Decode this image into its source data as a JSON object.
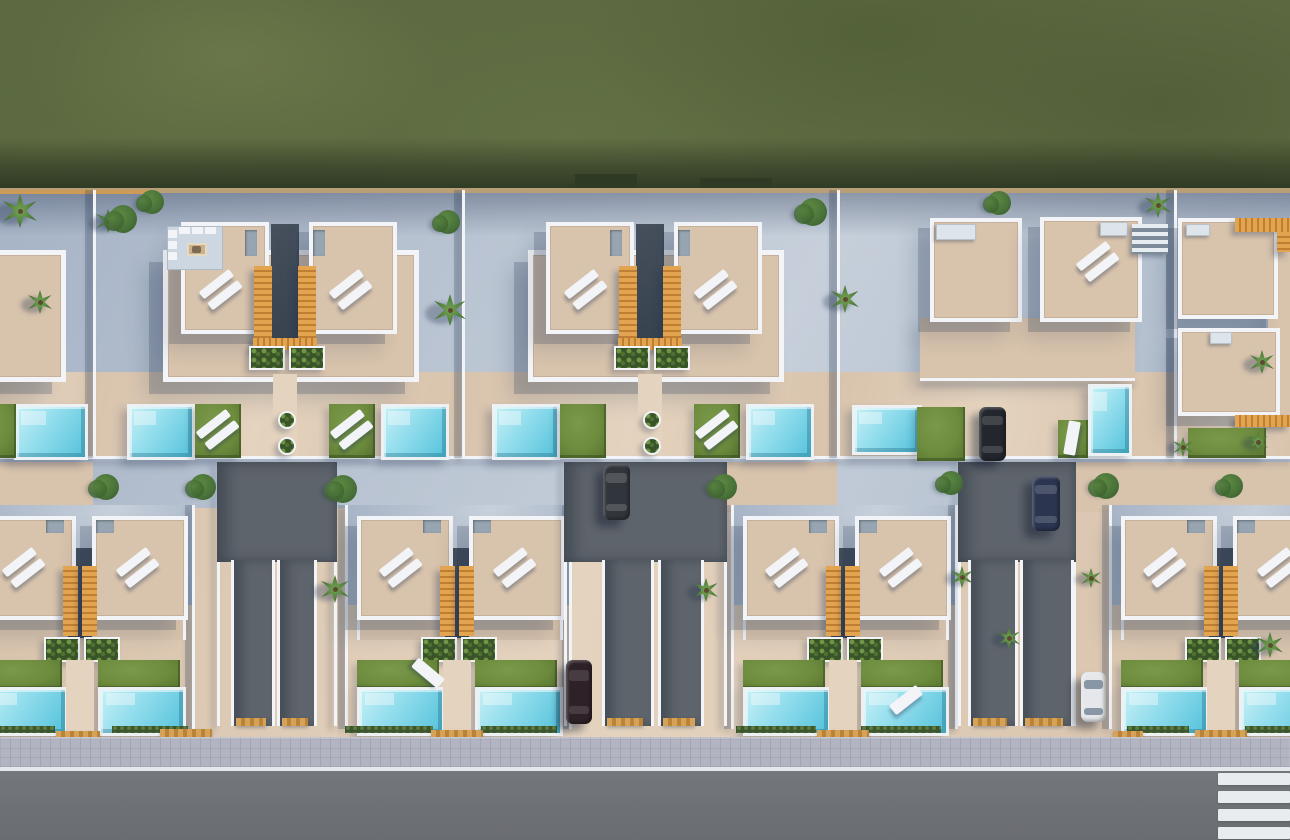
{
  "scene": {
    "width": 1290,
    "height": 840,
    "description": "aerial-3d-render-villa-development"
  },
  "colors": {
    "field": "#5c6941",
    "fieldDark": "#46522f",
    "paving": "#a7b4c6",
    "pavingLight": "#c6cfda",
    "beige": "#d8c3ac",
    "beigeLight": "#e4d3be",
    "beigeShade": "#c2ab92",
    "white": "#f2f4f7",
    "rim": "#eef1f4",
    "stairs": "#dd9b45",
    "lawn": "#6d8c3d",
    "lawnDark": "#57722f",
    "poolLight": "#c6f0f6",
    "pool": "#8fdcec",
    "poolDark": "#55c2da",
    "lane": "#5e646b",
    "road": "#6f7377",
    "sidewalk": "#b3b4c1",
    "stripe": "#e9ecee",
    "kerb": "#d09a4c",
    "treeGreen": "#497239",
    "treeDark": "#35592a",
    "backWall": "#b99f78",
    "backWallOrange": "#cd9a57",
    "kitchenFloor": "#ccd7e1",
    "equip": "#dde4ea",
    "shadowSoft": "rgba(38,54,84,0.22)"
  },
  "field": {
    "h": 190,
    "shadowY": 138,
    "shadowH": 52,
    "wallY": 188,
    "wallH": 5,
    "orangeSeg": [
      0,
      190,
      150,
      4
    ],
    "notches": [
      [
        575,
        174,
        62,
        16
      ],
      [
        700,
        178,
        72,
        12
      ]
    ]
  },
  "topRow": {
    "wallXs": [
      93,
      462,
      837,
      1174
    ],
    "frontRanges": [
      [
        0,
        93
      ],
      [
        93,
        462
      ],
      [
        462,
        837
      ],
      [
        837,
        1174
      ],
      [
        1174,
        1290
      ]
    ],
    "frontY": 372,
    "frontH": 86,
    "frontWallY": 456,
    "pairs": [
      {
        "cx": 285,
        "kitchen": true,
        "lawnLoungers": [
          "left",
          "right"
        ]
      },
      {
        "cx": 650,
        "kitchen": false,
        "lawnLoungers": [
          "right"
        ]
      }
    ],
    "partial": {
      "terrace": [
        -70,
        250,
        126,
        122
      ],
      "pool": [
        14,
        404,
        68,
        50
      ],
      "lawn": [
        -30,
        404,
        46,
        54
      ]
    }
  },
  "cornerTop": {
    "squares": [
      [
        930,
        218,
        84,
        96
      ],
      [
        1040,
        217,
        94,
        97
      ],
      [
        1178,
        218,
        92,
        93
      ],
      [
        1178,
        328,
        94,
        80
      ]
    ],
    "equip": [
      [
        936,
        224,
        40,
        16
      ],
      [
        1100,
        222,
        28,
        14
      ],
      [
        1186,
        224,
        24,
        12
      ],
      [
        1210,
        332,
        22,
        12
      ]
    ],
    "extStair": [
      1132,
      224,
      36,
      30
    ],
    "orangeH": [
      [
        1235,
        218,
        55,
        14
      ],
      [
        1235,
        415,
        55,
        12
      ]
    ],
    "orangeV": [
      [
        1277,
        232,
        13,
        20
      ]
    ],
    "terraces": [
      [
        920,
        318,
        215,
        62
      ],
      [
        1268,
        238,
        22,
        176
      ]
    ],
    "terraceWall": [
      920,
      378,
      215,
      3
    ],
    "hPool": [
      852,
      405,
      64,
      44
    ],
    "vPool": [
      1088,
      384,
      38,
      66
    ],
    "lawns": [
      [
        917,
        407,
        48,
        54
      ],
      [
        1058,
        420,
        30,
        38
      ],
      [
        1188,
        428,
        78,
        30
      ]
    ],
    "roofLoungers": [
      [
        1098,
        262,
        -38
      ]
    ],
    "lawnLoungers": [
      [
        1072,
        438,
        -80
      ]
    ]
  },
  "bottomRow": {
    "pairs": [
      {
        "cx": 80
      },
      {
        "cx": 457
      },
      {
        "cx": 843
      },
      {
        "cx": 1221
      }
    ]
  },
  "lanes": [
    {
      "upper": [
        217,
        462,
        120,
        100
      ],
      "drives": [
        [
          231,
          560,
          38,
          166
        ],
        [
          277,
          560,
          34,
          166
        ]
      ]
    },
    {
      "upper": [
        564,
        462,
        163,
        100
      ],
      "drives": [
        [
          602,
          560,
          46,
          166
        ],
        [
          658,
          560,
          40,
          166
        ]
      ]
    },
    {
      "upper": [
        958,
        462,
        118,
        100
      ],
      "drives": [
        [
          968,
          560,
          44,
          166
        ],
        [
          1020,
          560,
          48,
          166
        ]
      ]
    }
  ],
  "midPatches": [
    [
      0,
      462,
      93,
      50
    ],
    [
      727,
      462,
      110,
      50
    ],
    [
      1076,
      462,
      214,
      50
    ]
  ],
  "trees": [
    {
      "type": "palm",
      "x": 20,
      "y": 211,
      "r": 17
    },
    {
      "type": "palm",
      "x": 108,
      "y": 221,
      "r": 12
    },
    {
      "type": "palm",
      "x": 450,
      "y": 310,
      "r": 16
    },
    {
      "type": "palm",
      "x": 40,
      "y": 302,
      "r": 12
    },
    {
      "type": "palm",
      "x": 845,
      "y": 299,
      "r": 14
    },
    {
      "type": "palm",
      "x": 1158,
      "y": 205,
      "r": 13
    },
    {
      "type": "palm",
      "x": 1262,
      "y": 362,
      "r": 12
    },
    {
      "type": "palm",
      "x": 335,
      "y": 589,
      "r": 14
    },
    {
      "type": "palm",
      "x": 706,
      "y": 590,
      "r": 12
    },
    {
      "type": "palm",
      "x": 962,
      "y": 577,
      "r": 11
    },
    {
      "type": "palm",
      "x": 1009,
      "y": 638,
      "r": 11
    },
    {
      "type": "palm",
      "x": 1091,
      "y": 578,
      "r": 10
    },
    {
      "type": "palm",
      "x": 1270,
      "y": 645,
      "r": 13
    },
    {
      "type": "palm",
      "x": 1183,
      "y": 447,
      "r": 10
    },
    {
      "type": "palm",
      "x": 1258,
      "y": 442,
      "r": 10
    },
    {
      "type": "tree",
      "x": 152,
      "y": 202,
      "r": 12
    },
    {
      "type": "tree",
      "x": 123,
      "y": 219,
      "r": 14
    },
    {
      "type": "tree",
      "x": 448,
      "y": 222,
      "r": 12
    },
    {
      "type": "tree",
      "x": 813,
      "y": 212,
      "r": 14
    },
    {
      "type": "tree",
      "x": 999,
      "y": 203,
      "r": 12
    },
    {
      "type": "tree",
      "x": 106,
      "y": 487,
      "r": 13
    },
    {
      "type": "tree",
      "x": 203,
      "y": 487,
      "r": 13
    },
    {
      "type": "tree",
      "x": 343,
      "y": 489,
      "r": 14
    },
    {
      "type": "tree",
      "x": 724,
      "y": 487,
      "r": 13
    },
    {
      "type": "tree",
      "x": 951,
      "y": 483,
      "r": 12
    },
    {
      "type": "tree",
      "x": 1106,
      "y": 486,
      "r": 13
    },
    {
      "type": "tree",
      "x": 1231,
      "y": 486,
      "r": 12
    }
  ],
  "cars": [
    {
      "x": 603,
      "y": 464,
      "w": 27,
      "h": 56,
      "body": "#31363c",
      "band": "rgba(255,255,255,0.16)"
    },
    {
      "x": 979,
      "y": 407,
      "w": 27,
      "h": 54,
      "body": "#23272d",
      "band": "rgba(255,255,255,0.14)"
    },
    {
      "x": 566,
      "y": 660,
      "w": 26,
      "h": 64,
      "body": "#2e2228",
      "band": "rgba(255,255,255,0.12)"
    },
    {
      "x": 1081,
      "y": 672,
      "w": 25,
      "h": 50,
      "body": "#e5e7ea",
      "band": "rgba(45,70,95,0.5)"
    },
    {
      "x": 1032,
      "y": 476,
      "w": 28,
      "h": 55,
      "body": "#2c3550",
      "band": "rgba(255,255,255,0.16)"
    }
  ],
  "extraLoungers": [
    [
      428,
      673,
      40
    ],
    [
      906,
      700,
      -38
    ]
  ],
  "hedges": [
    [
      0,
      726,
      55,
      7
    ],
    [
      112,
      726,
      76,
      7
    ],
    [
      345,
      726,
      88,
      7
    ],
    [
      481,
      726,
      76,
      7
    ],
    [
      736,
      726,
      80,
      7
    ],
    [
      861,
      726,
      80,
      7
    ],
    [
      1127,
      726,
      62,
      7
    ],
    [
      1245,
      726,
      45,
      7
    ]
  ],
  "kerbs": [
    [
      56,
      731,
      44,
      8
    ],
    [
      160,
      729,
      52,
      8
    ],
    [
      236,
      718,
      30,
      8
    ],
    [
      282,
      718,
      26,
      8
    ],
    [
      431,
      730,
      52,
      7
    ],
    [
      607,
      718,
      36,
      8
    ],
    [
      663,
      718,
      32,
      8
    ],
    [
      817,
      730,
      52,
      7
    ],
    [
      973,
      718,
      34,
      8
    ],
    [
      1025,
      718,
      38,
      8
    ],
    [
      1113,
      731,
      30,
      7
    ],
    [
      1195,
      730,
      52,
      7
    ]
  ],
  "sidewalk": {
    "y": 737,
    "h": 30
  },
  "roadLine": {
    "y": 767,
    "h": 4
  },
  "road": {
    "y": 771,
    "h": 69
  },
  "crosswalk": {
    "x": 1218,
    "w": 72,
    "barH": 12,
    "ys": [
      773,
      791,
      809,
      827
    ]
  }
}
